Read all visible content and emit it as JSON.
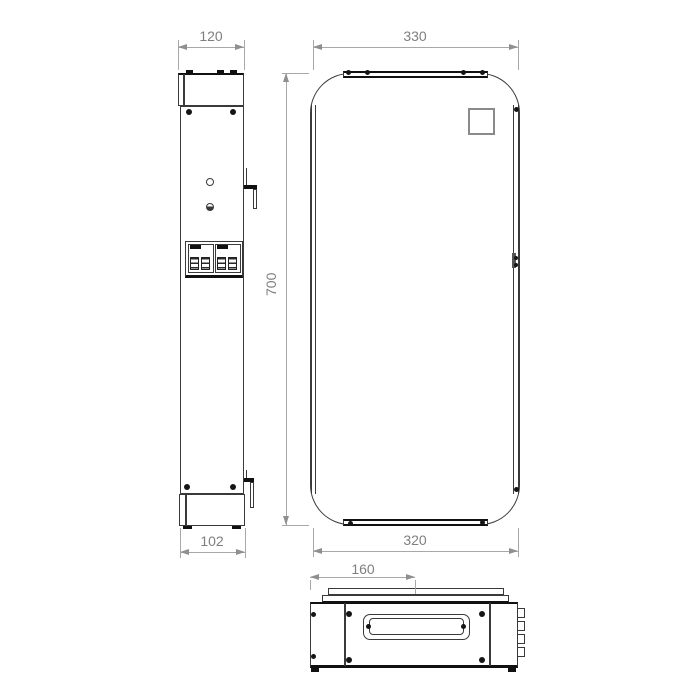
{
  "drawing": {
    "kind": "technical-dimension-drawing",
    "views": [
      "side-view",
      "front-view",
      "bottom-view"
    ]
  },
  "colors": {
    "outline": "#3a3a3a",
    "heavy_line": "#111111",
    "dimension_line": "#a8a8a8",
    "dimension_text": "#7f7f7f",
    "logo_border": "#8a8a8a",
    "background": "#ffffff"
  },
  "dimensions": {
    "side_width_mm": "120",
    "front_width_mm": "330",
    "height_mm": "700",
    "side_depth_mm": "102",
    "front_bottom_width_mm": "320",
    "bottom_plate_width_mm": "160"
  }
}
